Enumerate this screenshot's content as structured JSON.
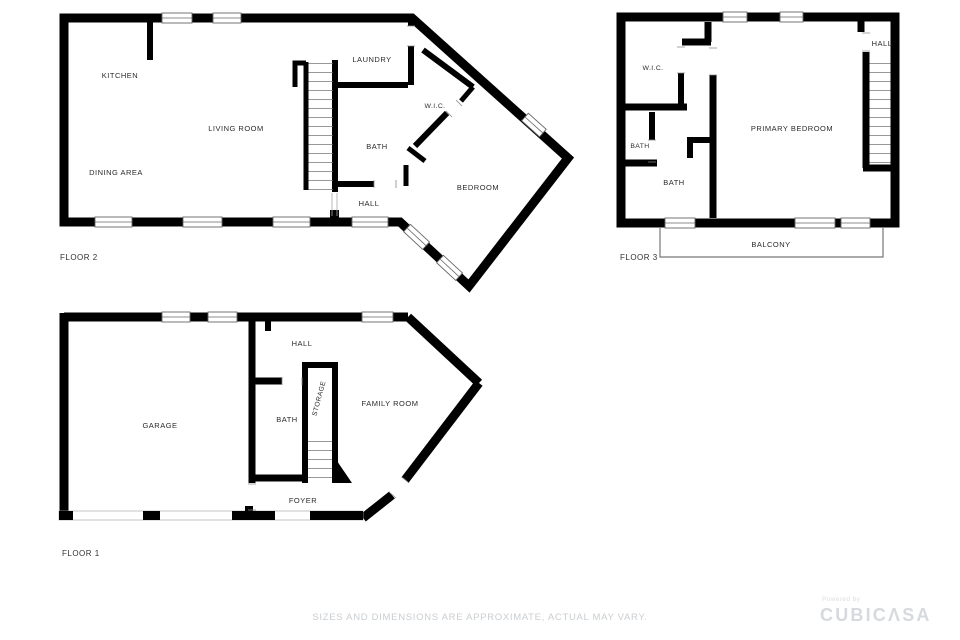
{
  "floors": [
    {
      "label": "FLOOR 2",
      "rooms": {
        "kitchen": "KITCHEN",
        "living_room": "LIVING ROOM",
        "dining_area": "DINING AREA",
        "laundry": "LAUNDRY",
        "wic": "W.I.C.",
        "bath": "BATH",
        "hall": "HALL",
        "bedroom": "BEDROOM"
      }
    },
    {
      "label": "FLOOR 3",
      "rooms": {
        "wic": "W.I.C.",
        "bath_small": "BATH",
        "bath": "BATH",
        "primary_bedroom": "PRIMARY BEDROOM",
        "hall": "HALL",
        "balcony": "BALCONY"
      }
    },
    {
      "label": "FLOOR 1",
      "rooms": {
        "garage": "GARAGE",
        "hall": "HALL",
        "bath": "BATH",
        "storage": "STORAGE",
        "family_room": "FAMILY ROOM",
        "foyer": "FOYER"
      }
    }
  ],
  "footer": {
    "disclaimer": "SIZES AND DIMENSIONS ARE APPROXIMATE, ACTUAL MAY VARY.",
    "logo": {
      "powered_by": "Powered by",
      "brand_prefix": "CUBIC",
      "brand_caret": "Λ",
      "brand_suffix": "SA"
    }
  },
  "colors": {
    "wall": "#000000",
    "room_fill": "#ffffff",
    "label_text": "#2b2b2b",
    "window_line": "#666666",
    "tread_line": "#999999",
    "footer_text": "#c9ced2",
    "logo_text": "#d6dade"
  }
}
